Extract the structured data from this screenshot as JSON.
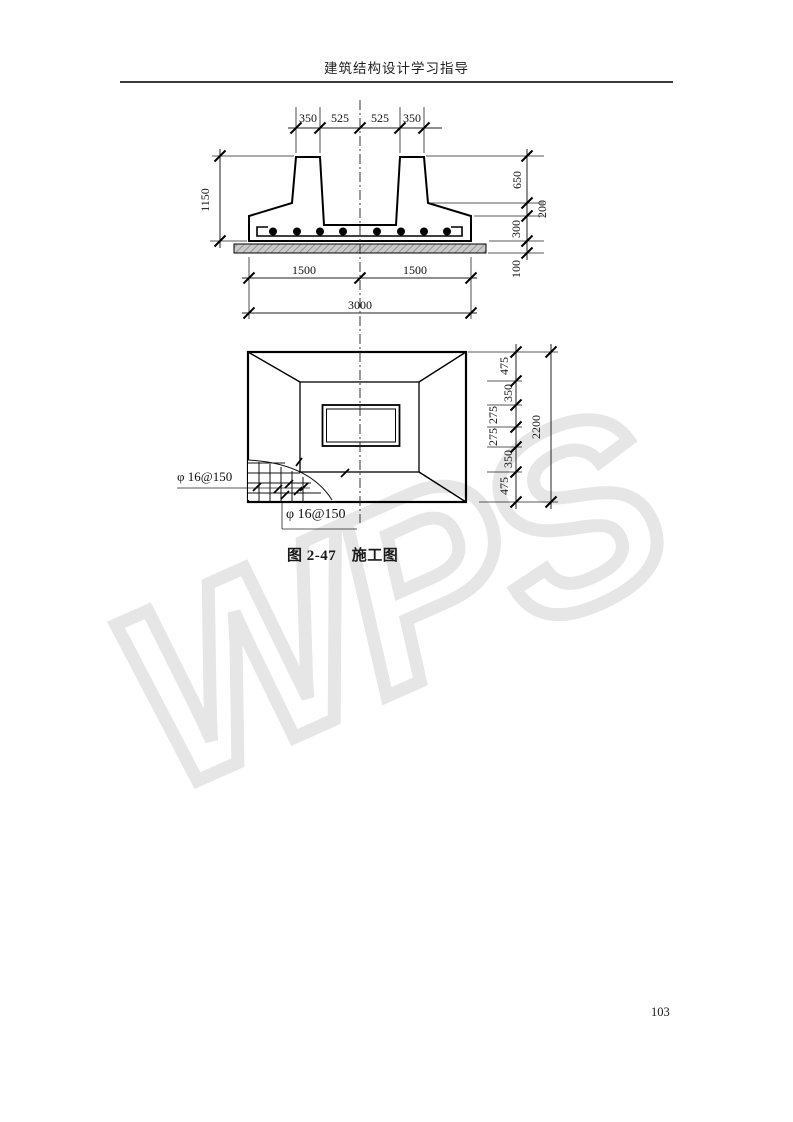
{
  "page": {
    "header": "建筑结构设计学习指导",
    "page_number": "103",
    "watermark": "WPS"
  },
  "figure": {
    "caption": "图 2-47　施工图",
    "section_view": {
      "top_dims": [
        "350",
        "525",
        "525",
        "350"
      ],
      "left_dim": "1150",
      "right_dims": [
        "650",
        "200",
        "300",
        "100"
      ],
      "bottom_dims": [
        "1500",
        "1500"
      ],
      "bottom_total": "3000"
    },
    "plan_view": {
      "right_dims": [
        "475",
        "350",
        "275",
        "275",
        "350",
        "475"
      ],
      "right_total": "2200",
      "rebar_label_left": "φ 16@150",
      "rebar_label_bottom": "φ 16@150"
    }
  }
}
